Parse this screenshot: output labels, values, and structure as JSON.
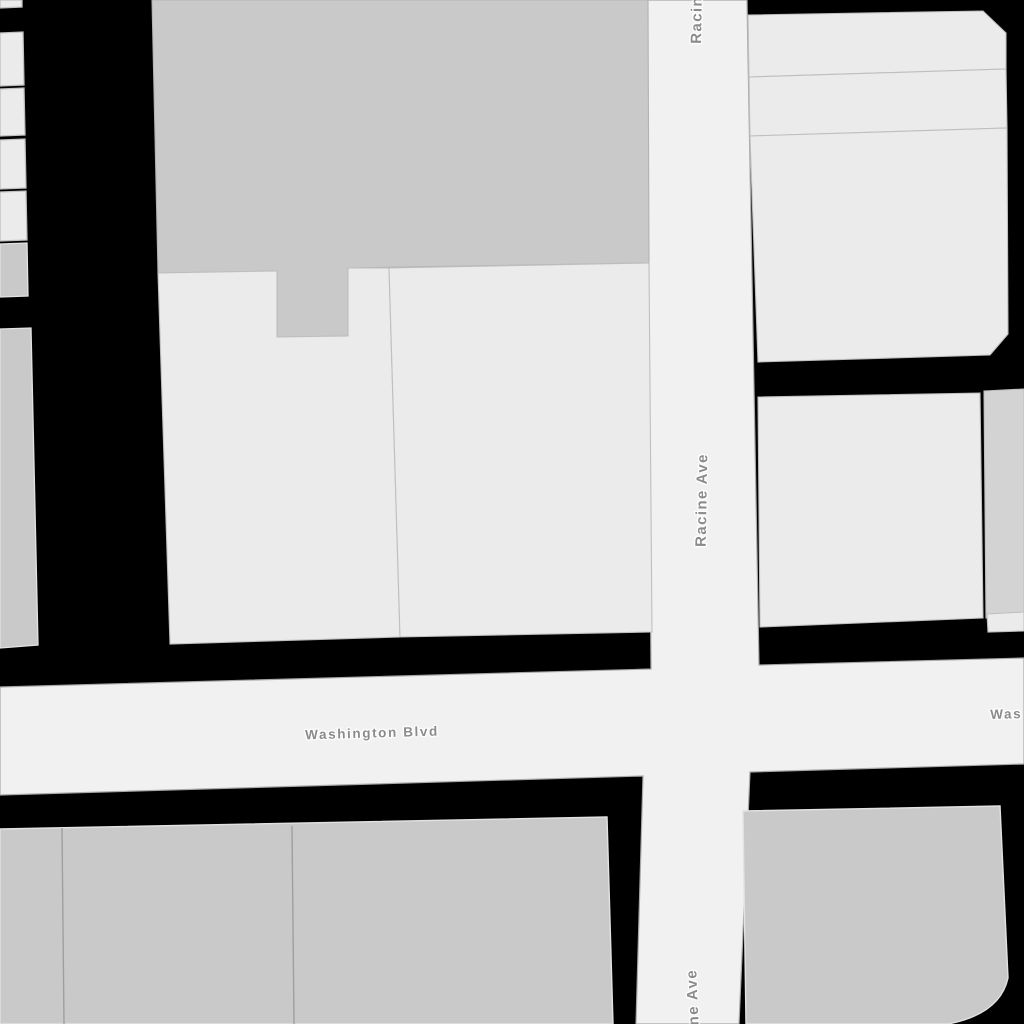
{
  "map": {
    "streets": [
      {
        "name": "Racine Ave",
        "orientation": "vertical"
      },
      {
        "name": "Washington Blvd",
        "orientation": "horizontal"
      }
    ],
    "labels": {
      "racine_top_partial": "Racine",
      "racine_middle": "Racine Ave",
      "racine_bottom_partial": "ine Ave",
      "washington_center": "Washington Blvd",
      "washington_right_partial": "Was"
    },
    "colors": {
      "background": "#000000",
      "street_fill": "#f1f1f1",
      "street_stroke": "#a8a8a8",
      "building_light_fill": "#ebebeb",
      "building_light_stroke": "#bfbfbf",
      "building_dark_fill": "#c9c9c9",
      "building_dark_stroke": "#e2e2e2",
      "building_mid_fill": "#d3d3d3",
      "label_text": "#8b8b8b",
      "label_halo": "#ffffff"
    }
  }
}
